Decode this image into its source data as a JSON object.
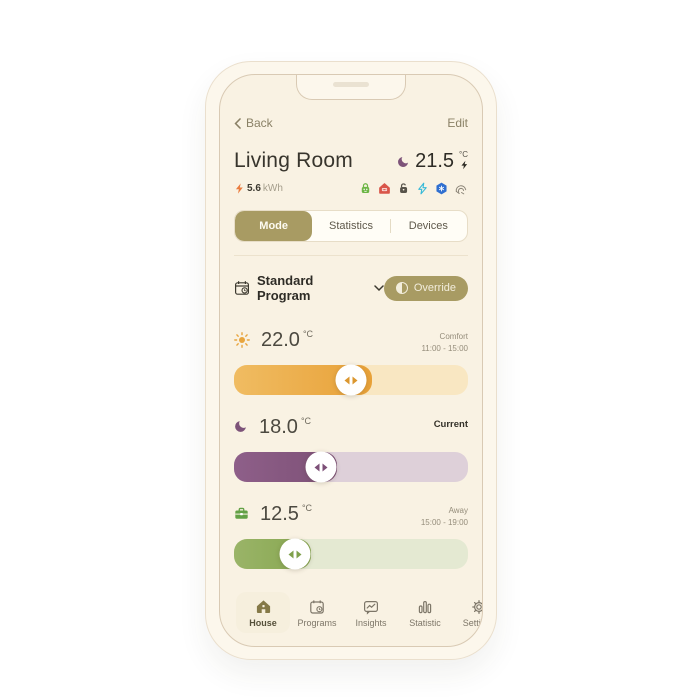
{
  "nav": {
    "back": "Back",
    "edit": "Edit"
  },
  "header": {
    "title": "Living Room",
    "mode_icon": "moon-icon",
    "current_temp": "21.5",
    "temp_unit": "°C",
    "heating_icon": "bolt-icon",
    "energy_icon": "bolt-icon",
    "energy_value": "5.6",
    "energy_unit": "kWh",
    "status_icons": [
      "green-lock-icon",
      "red-home-icon",
      "gray-lock-icon",
      "power-bolt-icon",
      "blue-hexagon-icon",
      "heating-coil-icon"
    ]
  },
  "segmented": {
    "active": "Mode",
    "items": [
      {
        "label": "Mode"
      },
      {
        "label": "Statistics"
      },
      {
        "label": "Devices"
      }
    ]
  },
  "program": {
    "icon": "calendar-clock-icon",
    "label": "Standard Program",
    "override_label": "Override",
    "override_icon": "half-circle-icon"
  },
  "schedule": {
    "rows": [
      {
        "icon": "sun-icon",
        "temp": "22.0",
        "unit": "°C",
        "label": "Comfort",
        "time": "11:00 - 15:00",
        "fill_percent": 59,
        "thumb_percent": 50,
        "fill_color": "#e8a138",
        "track_color": "#f9e7c2"
      },
      {
        "icon": "moon-icon",
        "temp": "18.0",
        "unit": "°C",
        "label": "Current",
        "time": "",
        "fill_percent": 44,
        "thumb_percent": 37,
        "fill_color": "#7d5076",
        "track_color": "#ded0d9"
      },
      {
        "icon": "briefcase-icon",
        "temp": "12.5",
        "unit": "°C",
        "label": "Away",
        "time": "15:00 - 19:00",
        "fill_percent": 33,
        "thumb_percent": 26,
        "fill_color": "#87a750",
        "track_color": "#e4e9d2"
      }
    ]
  },
  "tabbar": {
    "active": "House",
    "items": [
      {
        "label": "House",
        "icon": "house-icon"
      },
      {
        "label": "Programs",
        "icon": "calendar-clock-icon"
      },
      {
        "label": "Insights",
        "icon": "insights-icon"
      },
      {
        "label": "Statistic",
        "icon": "bar-chart-icon"
      },
      {
        "label": "Settings",
        "icon": "gear-icon"
      }
    ]
  },
  "colors": {
    "accent_olive": "#a89b63",
    "screen_bg": "#f9f2e3",
    "bezel": "#fcf7ec",
    "comfort_orange": "#e8a138",
    "current_purple": "#7d5076",
    "away_green": "#87a750",
    "ok_green": "#6cb544",
    "alert_red": "#d9564a",
    "info_blue": "#2f6fd0",
    "cyan": "#35b9d8"
  }
}
